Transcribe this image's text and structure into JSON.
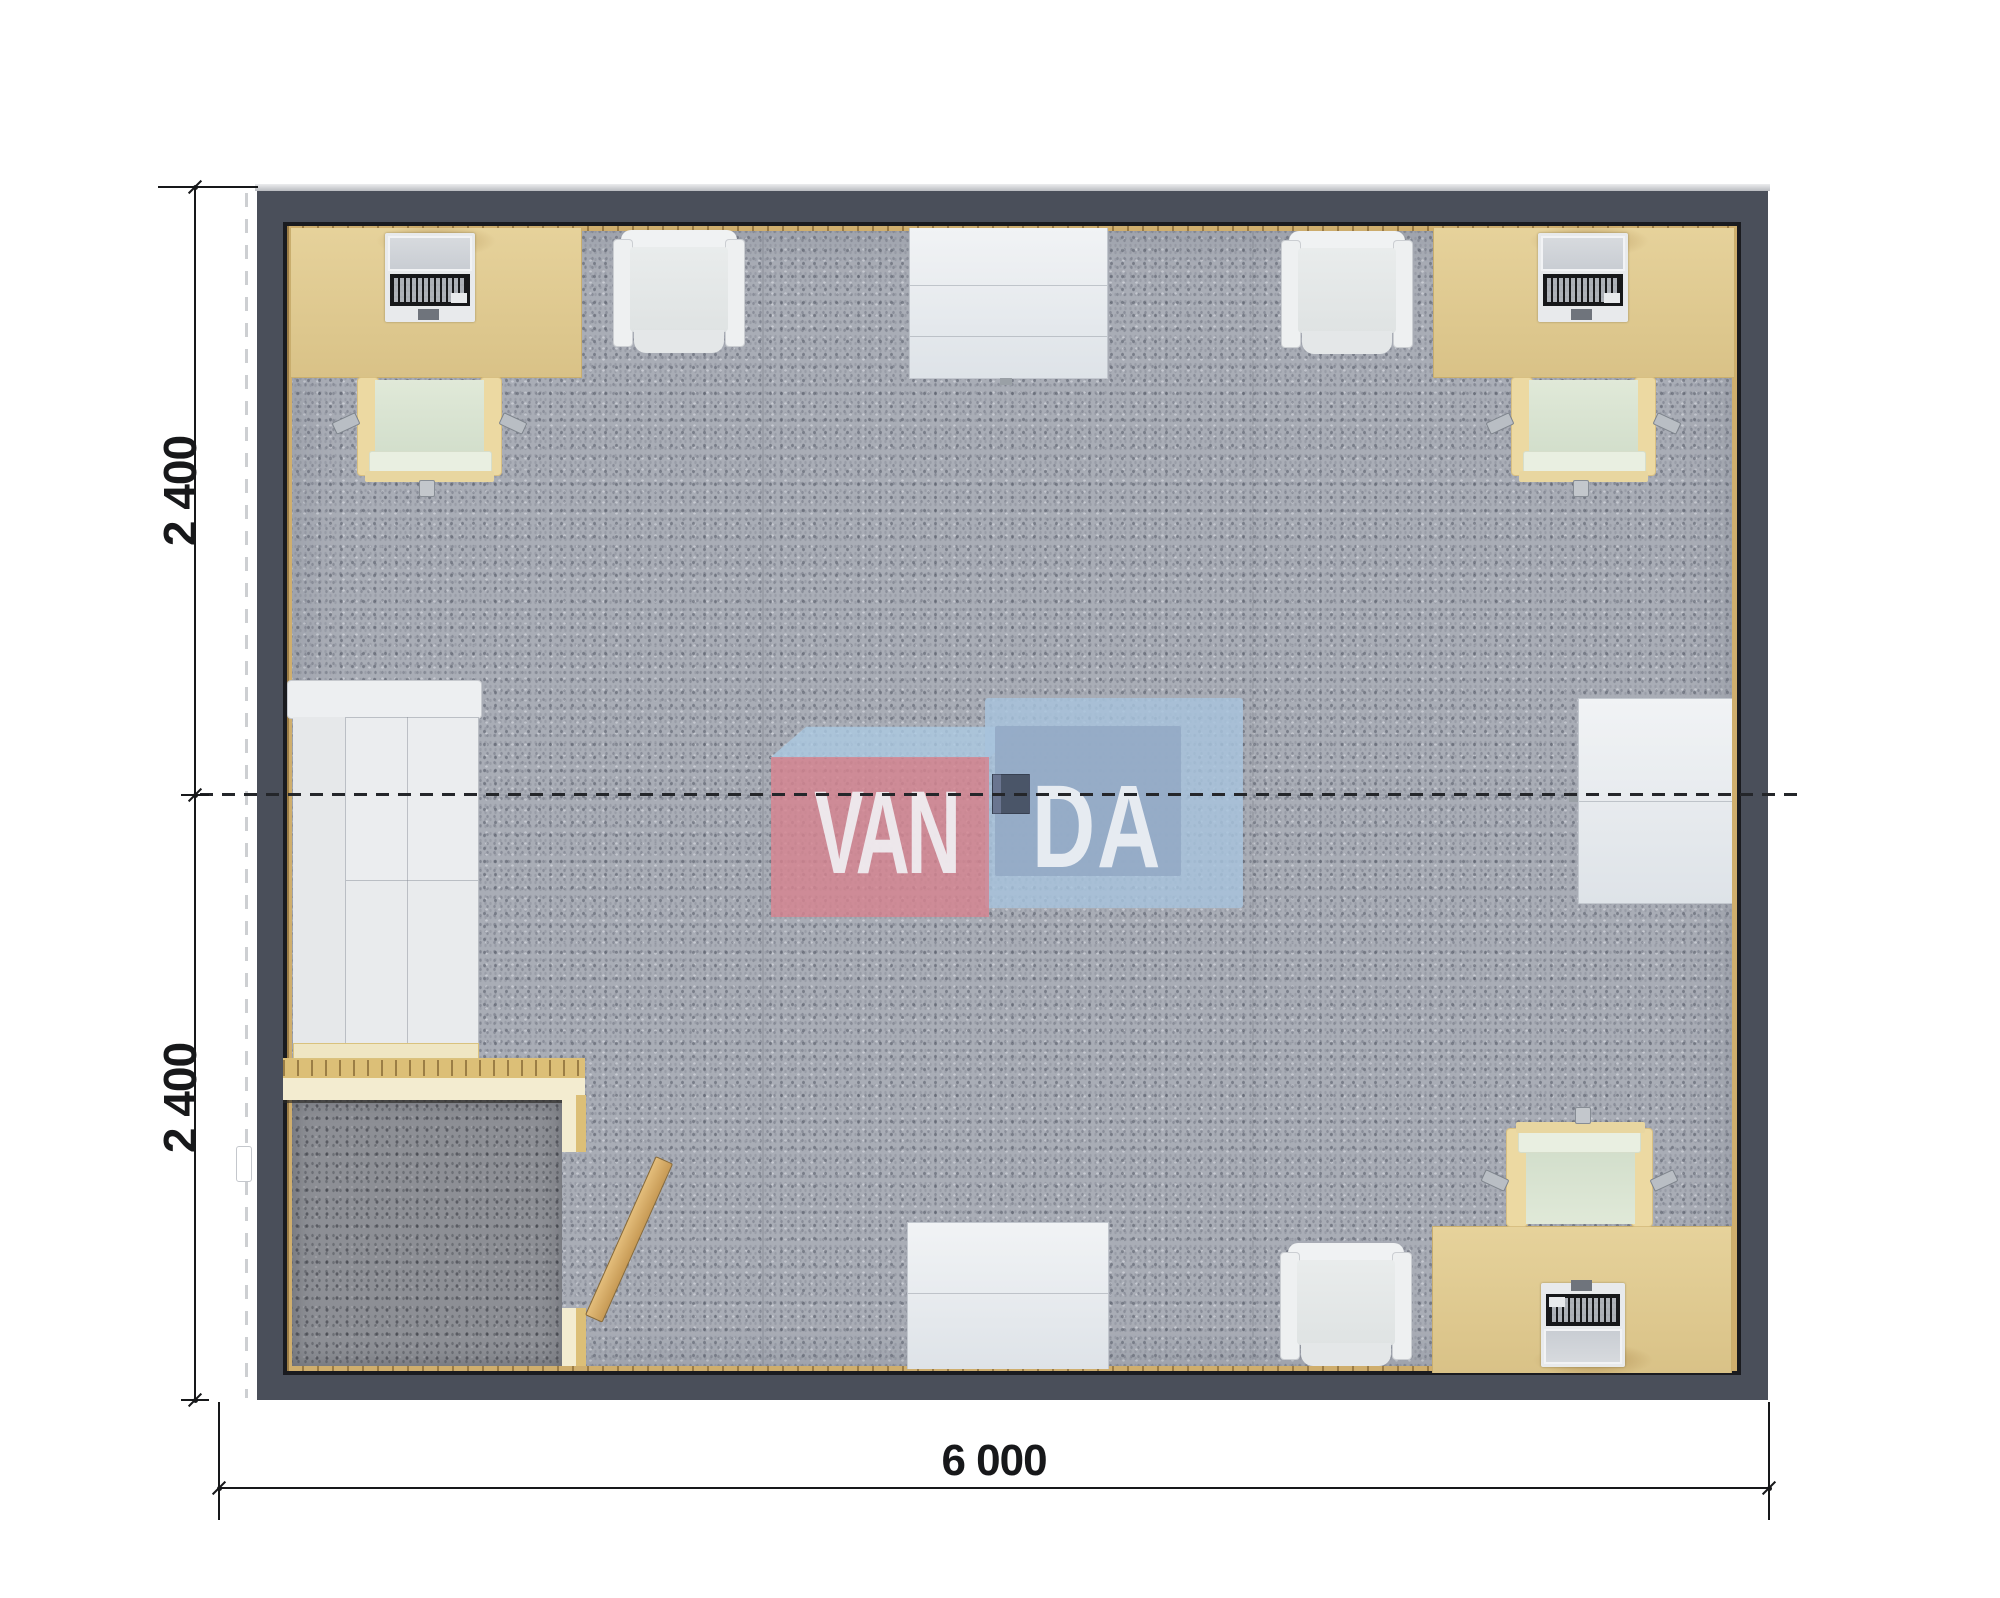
{
  "plan": {
    "type": "floor-plan-top-view",
    "module_width_label": "6 000",
    "module_depth_labels": [
      "2 400",
      "2 400"
    ]
  },
  "dimensions": {
    "left_top": "2 400",
    "left_bottom": "2 400",
    "bottom": "6 000"
  },
  "watermark": {
    "left_text": "VAN",
    "right_text": "DA",
    "pink": "#d58490",
    "blue_light": "#a7c3dd",
    "blue_mid": "#93aac5",
    "text_color": "#f1f4f7"
  },
  "colors": {
    "wall": "#4a4f5a",
    "floor_carpet": "#a9adb6",
    "vestibule_carpet": "#8d8f95",
    "desk_wood": "#e2cd94",
    "timber_liner": "#cfae6d",
    "partition": "#f3ecd0",
    "chair_seat": "#dce6d4",
    "white_furniture": "#edeff1",
    "dimension_line": "#17181a"
  }
}
